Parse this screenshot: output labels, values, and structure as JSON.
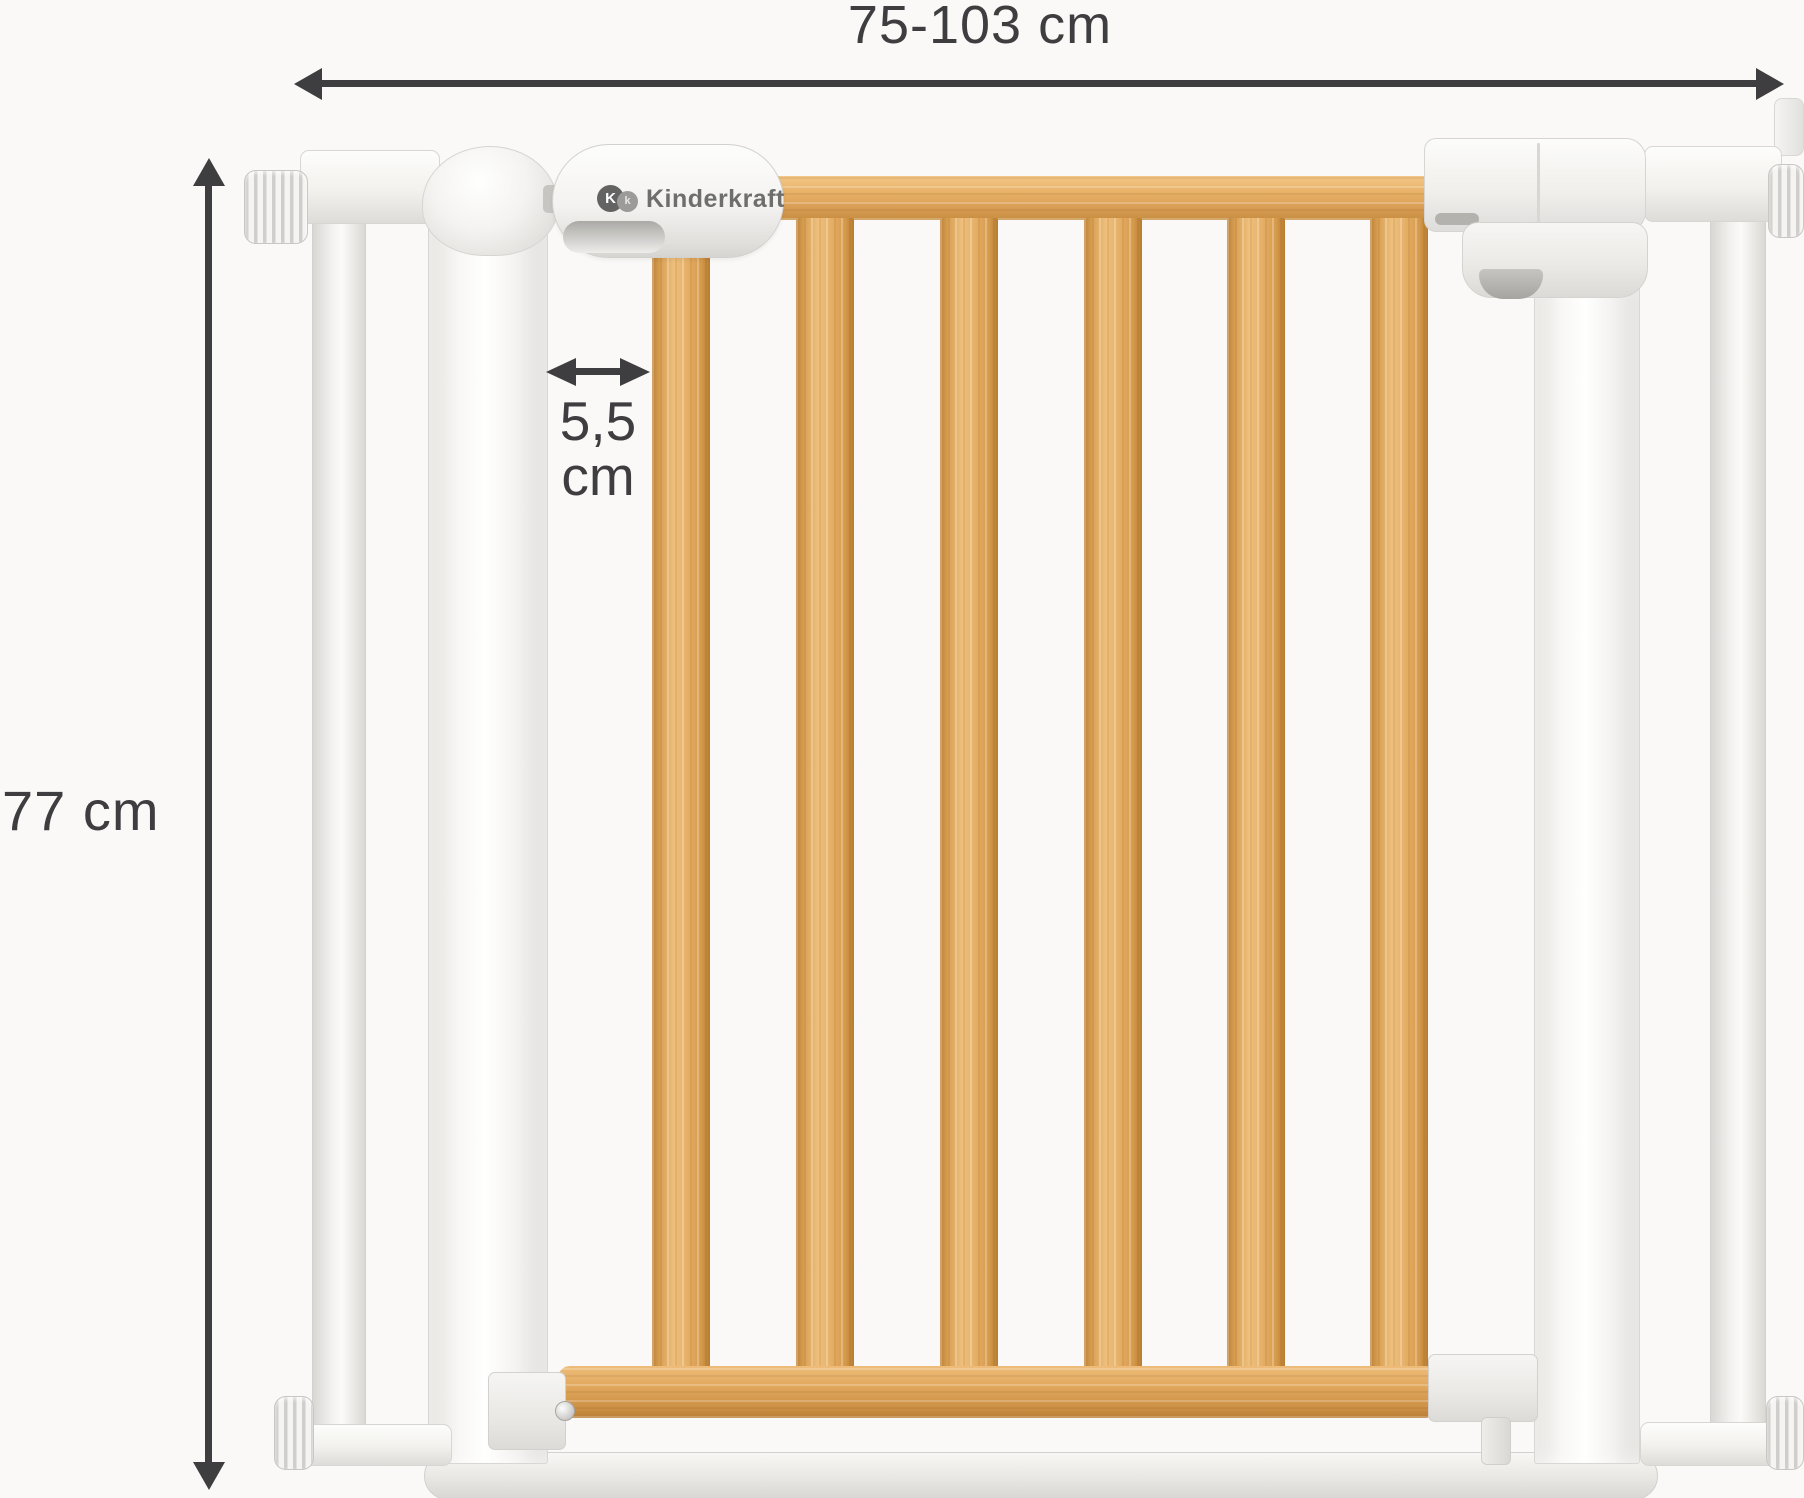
{
  "page": {
    "background": "#faf9f7"
  },
  "annotations": {
    "color": "#3e3e40",
    "width_label": "75-103 cm",
    "height_label": "77 cm",
    "gap_value": "5,5",
    "gap_unit": "cm"
  },
  "brand": {
    "name": "Kinderkraft",
    "monogram_primary": "K",
    "monogram_secondary": "k",
    "logo_text_color": "#6e6e6e"
  },
  "gate": {
    "slat_count": 6,
    "wood_color": "#e3aa60",
    "frame_color": "#f4f3f1"
  }
}
